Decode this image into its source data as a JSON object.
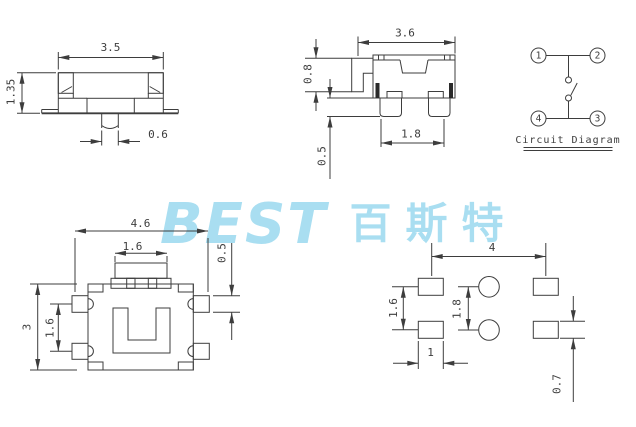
{
  "drawing_color": "#3d3d3d",
  "watermark": {
    "latin": "BEST",
    "cjk": "百斯特",
    "color": "#a9def1"
  },
  "views": {
    "front": {
      "dims": {
        "width": "3.5",
        "height": "1.35",
        "stem_width": "0.6"
      }
    },
    "side": {
      "dims": {
        "width": "3.6",
        "flange_height": "0.8",
        "leg_height": "0.5",
        "leg_pitch": "1.8"
      }
    },
    "circuit": {
      "title": "Circuit Diagram",
      "pins": {
        "top_left": "1",
        "top_right": "2",
        "bottom_right": "3",
        "bottom_left": "4"
      }
    },
    "top": {
      "dims": {
        "overall_width": "4.6",
        "button_width": "1.6",
        "pad_height": "0.5",
        "body_height": "3",
        "pad_pitch": "1.6"
      }
    },
    "footprint": {
      "dims": {
        "pad_span": "4",
        "pad_pitch": "1.6",
        "hole_pitch": "1.8",
        "pad_width": "1",
        "pad_height": "0.7"
      }
    }
  }
}
